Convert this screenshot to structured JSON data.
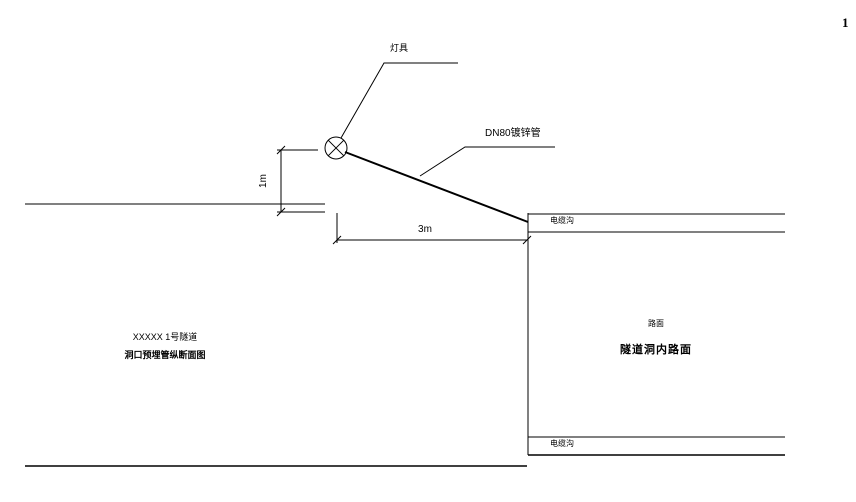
{
  "page": {
    "corner_mark": "1"
  },
  "drawing": {
    "type": "cad-detail",
    "labels": {
      "lamp": "灯具",
      "pipe": "DN80镀锌管",
      "dim_vertical": "1m",
      "dim_horizontal": "3m",
      "cable_trench_top": "电缆沟",
      "cable_trench_bottom": "电缆沟",
      "road_small": "路面",
      "road_title": "隧道洞内路面",
      "left_title_line1": "XXXXX 1号隧道",
      "left_title_line2": "洞口预埋管纵断面图"
    },
    "colors": {
      "line": "#000000",
      "background": "#ffffff"
    }
  }
}
